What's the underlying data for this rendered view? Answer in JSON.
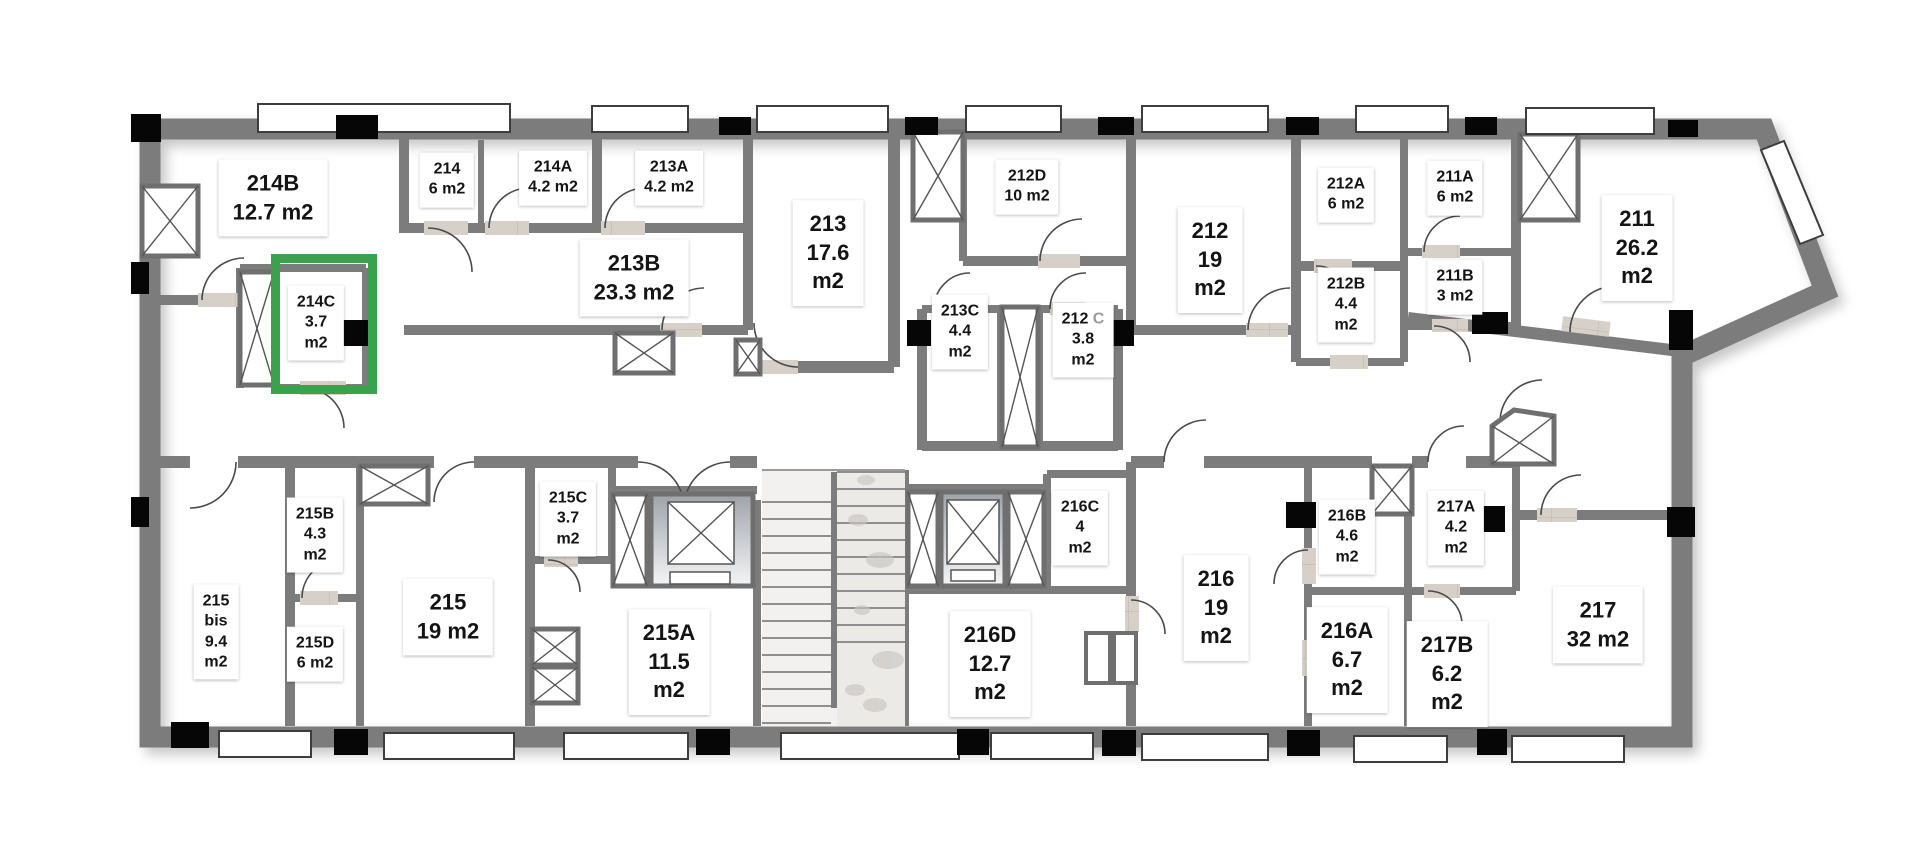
{
  "plan": {
    "type": "apartment-floor-plan",
    "unit_suffix": "m2",
    "colors": {
      "highlight_green": "#3aa24c",
      "wall_gray": "#7c7c7c",
      "floor_tile": "#d6d0c9",
      "label_bg": "#ffffff",
      "label_text": "#141414"
    },
    "highlight": {
      "room": "214C",
      "x": 271,
      "y": 254,
      "w": 106,
      "h": 140
    }
  },
  "rooms": [
    {
      "id": "214B",
      "area": "12.7 m2",
      "lines": [
        "214B",
        "12.7 m2"
      ],
      "cx": 273,
      "cy": 198,
      "size": "lg",
      "highlighted": false
    },
    {
      "id": "214",
      "area": "6 m2",
      "lines": [
        "214",
        "6 m2"
      ],
      "cx": 447,
      "cy": 180,
      "size": "sm",
      "highlighted": false
    },
    {
      "id": "214A",
      "area": "4.2 m2",
      "lines": [
        "214A",
        "4.2 m2"
      ],
      "cx": 553,
      "cy": 178,
      "size": "sm",
      "highlighted": false
    },
    {
      "id": "213A",
      "area": "4.2 m2",
      "lines": [
        "213A",
        "4.2 m2"
      ],
      "cx": 669,
      "cy": 178,
      "size": "sm",
      "highlighted": false
    },
    {
      "id": "213B",
      "area": "23.3 m2",
      "lines": [
        "213B",
        "23.3 m2"
      ],
      "cx": 634,
      "cy": 278,
      "size": "lg",
      "highlighted": false
    },
    {
      "id": "213",
      "area": "17.6 m2",
      "lines": [
        "213",
        "17.6",
        "m2"
      ],
      "cx": 828,
      "cy": 253,
      "size": "lg",
      "highlighted": false
    },
    {
      "id": "212D",
      "area": "10 m2",
      "lines": [
        "212D",
        "10 m2"
      ],
      "cx": 1027,
      "cy": 187,
      "size": "sm",
      "highlighted": false
    },
    {
      "id": "214C",
      "area": "3.7 m2",
      "lines": [
        "214C",
        "3.7",
        "m2"
      ],
      "cx": 316,
      "cy": 323,
      "size": "sm",
      "highlighted": true
    },
    {
      "id": "213C",
      "area": "4.4 m2",
      "lines": [
        "213C",
        "4.4",
        "m2"
      ],
      "cx": 960,
      "cy": 332,
      "size": "sm",
      "highlighted": false
    },
    {
      "id": "212C",
      "area": "3.8 m2",
      "lines": [
        "212|C",
        "3.8",
        "m2"
      ],
      "cx": 1083,
      "cy": 340,
      "size": "sm",
      "highlighted": false
    },
    {
      "id": "212",
      "area": "19 m2",
      "lines": [
        "212",
        "19",
        "m2"
      ],
      "cx": 1210,
      "cy": 260,
      "size": "lg",
      "highlighted": false
    },
    {
      "id": "212A",
      "area": "6 m2",
      "lines": [
        "212A",
        "6 m2"
      ],
      "cx": 1346,
      "cy": 195,
      "size": "sm",
      "highlighted": false
    },
    {
      "id": "211A",
      "area": "6 m2",
      "lines": [
        "211A",
        "6 m2"
      ],
      "cx": 1455,
      "cy": 188,
      "size": "sm",
      "highlighted": false
    },
    {
      "id": "212B",
      "area": "4.4 m2",
      "lines": [
        "212B",
        "4.4",
        "m2"
      ],
      "cx": 1346,
      "cy": 305,
      "size": "sm",
      "highlighted": false
    },
    {
      "id": "211B",
      "area": "3 m2",
      "lines": [
        "211B",
        "3 m2"
      ],
      "cx": 1455,
      "cy": 287,
      "size": "sm",
      "highlighted": false
    },
    {
      "id": "211",
      "area": "26.2 m2",
      "lines": [
        "211",
        "26.2",
        "m2"
      ],
      "cx": 1637,
      "cy": 248,
      "size": "lg",
      "highlighted": false
    },
    {
      "id": "215B",
      "area": "4.3 m2",
      "lines": [
        "215B",
        "4.3",
        "m2"
      ],
      "cx": 315,
      "cy": 535,
      "size": "sm",
      "highlighted": false
    },
    {
      "id": "215C",
      "area": "3.7 m2",
      "lines": [
        "215C",
        "3.7",
        "m2"
      ],
      "cx": 568,
      "cy": 519,
      "size": "sm",
      "highlighted": false
    },
    {
      "id": "215 bis",
      "area": "9.4 m2",
      "lines": [
        "215",
        "bis",
        "9.4",
        "m2"
      ],
      "cx": 216,
      "cy": 632,
      "size": "sm",
      "highlighted": false
    },
    {
      "id": "215",
      "area": "19 m2",
      "lines": [
        "215",
        "19 m2"
      ],
      "cx": 448,
      "cy": 617,
      "size": "lg",
      "highlighted": false
    },
    {
      "id": "215D",
      "area": "6 m2",
      "lines": [
        "215D",
        "6 m2"
      ],
      "cx": 315,
      "cy": 654,
      "size": "sm",
      "highlighted": false
    },
    {
      "id": "215A",
      "area": "11.5 m2",
      "lines": [
        "215A",
        "11.5",
        "m2"
      ],
      "cx": 669,
      "cy": 662,
      "size": "lg",
      "highlighted": false
    },
    {
      "id": "216C",
      "area": "4 m2",
      "lines": [
        "216C",
        "4",
        "m2"
      ],
      "cx": 1080,
      "cy": 528,
      "size": "sm",
      "highlighted": false
    },
    {
      "id": "216D",
      "area": "12.7 m2",
      "lines": [
        "216D",
        "12.7",
        "m2"
      ],
      "cx": 990,
      "cy": 664,
      "size": "lg",
      "highlighted": false
    },
    {
      "id": "216",
      "area": "19 m2",
      "lines": [
        "216",
        "19",
        "m2"
      ],
      "cx": 1216,
      "cy": 608,
      "size": "lg",
      "highlighted": false
    },
    {
      "id": "216B",
      "area": "4.6 m2",
      "lines": [
        "216B",
        "4.6",
        "m2"
      ],
      "cx": 1347,
      "cy": 537,
      "size": "sm",
      "highlighted": false
    },
    {
      "id": "217A",
      "area": "4.2 m2",
      "lines": [
        "217A",
        "4.2",
        "m2"
      ],
      "cx": 1456,
      "cy": 528,
      "size": "sm",
      "highlighted": false
    },
    {
      "id": "216A",
      "area": "6.7 m2",
      "lines": [
        "216A",
        "6.7",
        "m2"
      ],
      "cx": 1347,
      "cy": 660,
      "size": "lg",
      "highlighted": false
    },
    {
      "id": "217B",
      "area": "6.2 m2",
      "lines": [
        "217B",
        "6.2",
        "m2"
      ],
      "cx": 1447,
      "cy": 674,
      "size": "lg",
      "highlighted": false
    },
    {
      "id": "217",
      "area": "32 m2",
      "lines": [
        "217",
        "32 m2"
      ],
      "cx": 1598,
      "cy": 625,
      "size": "lg",
      "highlighted": false
    }
  ]
}
